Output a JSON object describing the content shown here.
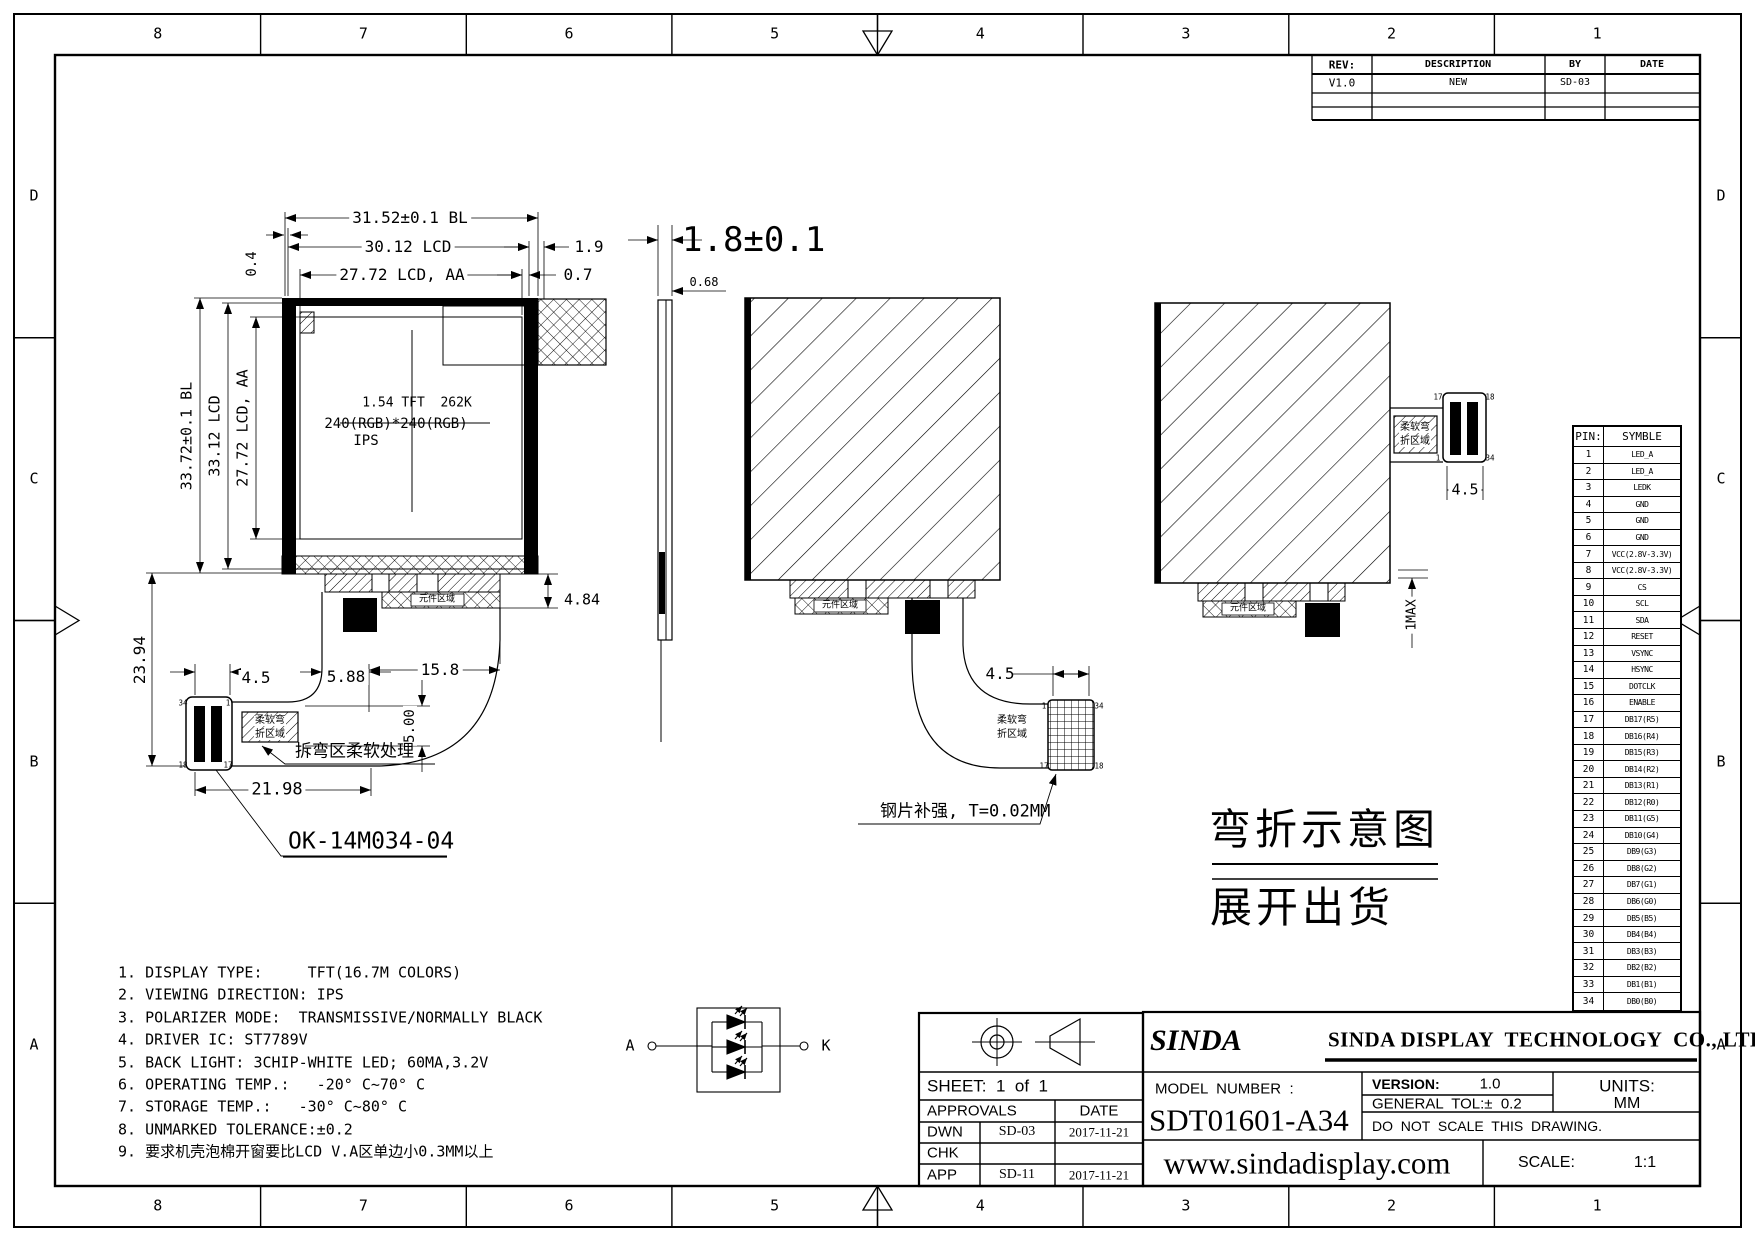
{
  "sheet": {
    "zones": {
      "columns": [
        "8",
        "7",
        "6",
        "5",
        "4",
        "3",
        "2",
        "1"
      ],
      "rows": [
        "D",
        "C",
        "B",
        "A"
      ]
    }
  },
  "revision_table": {
    "col_rev": "REV:",
    "col_description": "DESCRIPTION",
    "col_by": "BY",
    "col_date": "DATE",
    "rows": [
      {
        "rev": "V1.0",
        "description": "NEW",
        "by": "SD-03",
        "date": ""
      }
    ]
  },
  "front_view": {
    "display_text": {
      "line1": "1.54 TFT  262K",
      "line2": "240(RGB)*240(RGB)",
      "line3": "IPS"
    },
    "dims": {
      "width_bl": "31.52±0.1 BL",
      "width_lcd": "30.12 LCD",
      "edge_right_lcd": "1.9",
      "width_aa": "27.72 LCD, AA",
      "edge_right_aa": "0.7",
      "edge_left": "0.4",
      "height_bl": "33.72±0.1 BL",
      "height_lcd": "33.12 LCD",
      "height_aa": "27.72 LCD, AA",
      "tail_height": "23.94",
      "strip_height": "4.84",
      "conn_width": "4.5",
      "seg_a": "5.88",
      "seg_b": "15.8",
      "ribbon_width": "5.00",
      "tail_width": "21.98"
    },
    "component_area_label": "元件区域",
    "flex_zone_line1": "柔软弯",
    "flex_zone_line2": "折区域",
    "bend_note": "拆弯区柔软处理",
    "part_number": "OK-14M034-04",
    "pins": {
      "tl": "34",
      "tr": "1",
      "bl": "18",
      "br": "17"
    }
  },
  "side_view": {
    "thickness": "1.8±0.1",
    "offset": "0.68"
  },
  "middle_view": {
    "conn_width": "4.5",
    "steel_note": "钢片补强, T=0.02MM",
    "flex_zone_line1": "柔软弯",
    "flex_zone_line2": "折区域",
    "component_area_label": "元件区域",
    "pins": {
      "tl": "1",
      "tr": "34",
      "bl": "17",
      "br": "18"
    }
  },
  "right_view": {
    "conn_width": "4.5",
    "max_fold": "1MAX",
    "flex_zone_line1": "柔软弯",
    "flex_zone_line2": "折区域",
    "component_area_label": "元件区域",
    "pins": {
      "tl": "17",
      "tr": "18",
      "bl": "1",
      "br": "34"
    }
  },
  "captions": {
    "fold": "弯折示意图",
    "unfold": "展开出货"
  },
  "led_circuit": {
    "anode_label": "A",
    "cathode_label": "K"
  },
  "notes": [
    "1. DISPLAY TYPE:     TFT(16.7M COLORS)",
    "2. VIEWING DIRECTION: IPS",
    "3. POLARIZER MODE:  TRANSMISSIVE/NORMALLY BLACK",
    "4. DRIVER IC: ST7789V",
    "5. BACK LIGHT: 3CHIP-WHITE LED; 60MA,3.2V",
    "6. OPERATING TEMP.:   -20° C~70° C",
    "7. STORAGE TEMP.:   -30° C~80° C",
    "8. UNMARKED TOLERANCE:±0.2",
    "9. 要求机壳泡棉开窗要比LCD V.A区单边小0.3MM以上"
  ],
  "pin_table": {
    "col_pin": "PIN:",
    "col_symbol": "SYMBLE",
    "rows": [
      [
        "1",
        "LED_A"
      ],
      [
        "2",
        "LED_A"
      ],
      [
        "3",
        "LEDK"
      ],
      [
        "4",
        "GND"
      ],
      [
        "5",
        "GND"
      ],
      [
        "6",
        "GND"
      ],
      [
        "7",
        "VCC(2.8V-3.3V)"
      ],
      [
        "8",
        "VCC(2.8V-3.3V)"
      ],
      [
        "9",
        "CS"
      ],
      [
        "10",
        "SCL"
      ],
      [
        "11",
        "SDA"
      ],
      [
        "12",
        "RESET"
      ],
      [
        "13",
        "VSYNC"
      ],
      [
        "14",
        "HSYNC"
      ],
      [
        "15",
        "DOTCLK"
      ],
      [
        "16",
        "ENABLE"
      ],
      [
        "17",
        "DB17(R5)"
      ],
      [
        "18",
        "DB16(R4)"
      ],
      [
        "19",
        "DB15(R3)"
      ],
      [
        "20",
        "DB14(R2)"
      ],
      [
        "21",
        "DB13(R1)"
      ],
      [
        "22",
        "DB12(R0)"
      ],
      [
        "23",
        "DB11(G5)"
      ],
      [
        "24",
        "DB10(G4)"
      ],
      [
        "25",
        "DB9(G3)"
      ],
      [
        "26",
        "DB8(G2)"
      ],
      [
        "27",
        "DB7(G1)"
      ],
      [
        "28",
        "DB6(G0)"
      ],
      [
        "29",
        "DB5(B5)"
      ],
      [
        "30",
        "DB4(B4)"
      ],
      [
        "31",
        "DB3(B3)"
      ],
      [
        "32",
        "DB2(B2)"
      ],
      [
        "33",
        "DB1(B1)"
      ],
      [
        "34",
        "DB0(B0)"
      ]
    ]
  },
  "approvals": {
    "sheet_label": "SHEET:  1  of  1",
    "approvals_label": "APPROVALS",
    "date_label": "DATE",
    "rows": [
      {
        "role": "DWN",
        "by": "SD-03",
        "date": "2017-11-21"
      },
      {
        "role": "CHK",
        "by": "",
        "date": ""
      },
      {
        "role": "APP",
        "by": "SD-11",
        "date": "2017-11-21"
      }
    ]
  },
  "title_block": {
    "logo_text": "SINDA",
    "company": "SINDA DISPLAY  TECHNOLOGY  CO., LTD.",
    "model_label": "MODEL  NUMBER  :",
    "model_number": "SDT01601-A34",
    "version_label": "VERSION:",
    "version": "1.0",
    "tolerance": "GENERAL  TOL:±  0.2",
    "no_scale": "DO  NOT  SCALE  THIS  DRAWING.",
    "units_label": "UNITS:",
    "units": "MM",
    "website": "www.sindadisplay.com",
    "scale_label": "SCALE:",
    "scale": "1:1"
  }
}
